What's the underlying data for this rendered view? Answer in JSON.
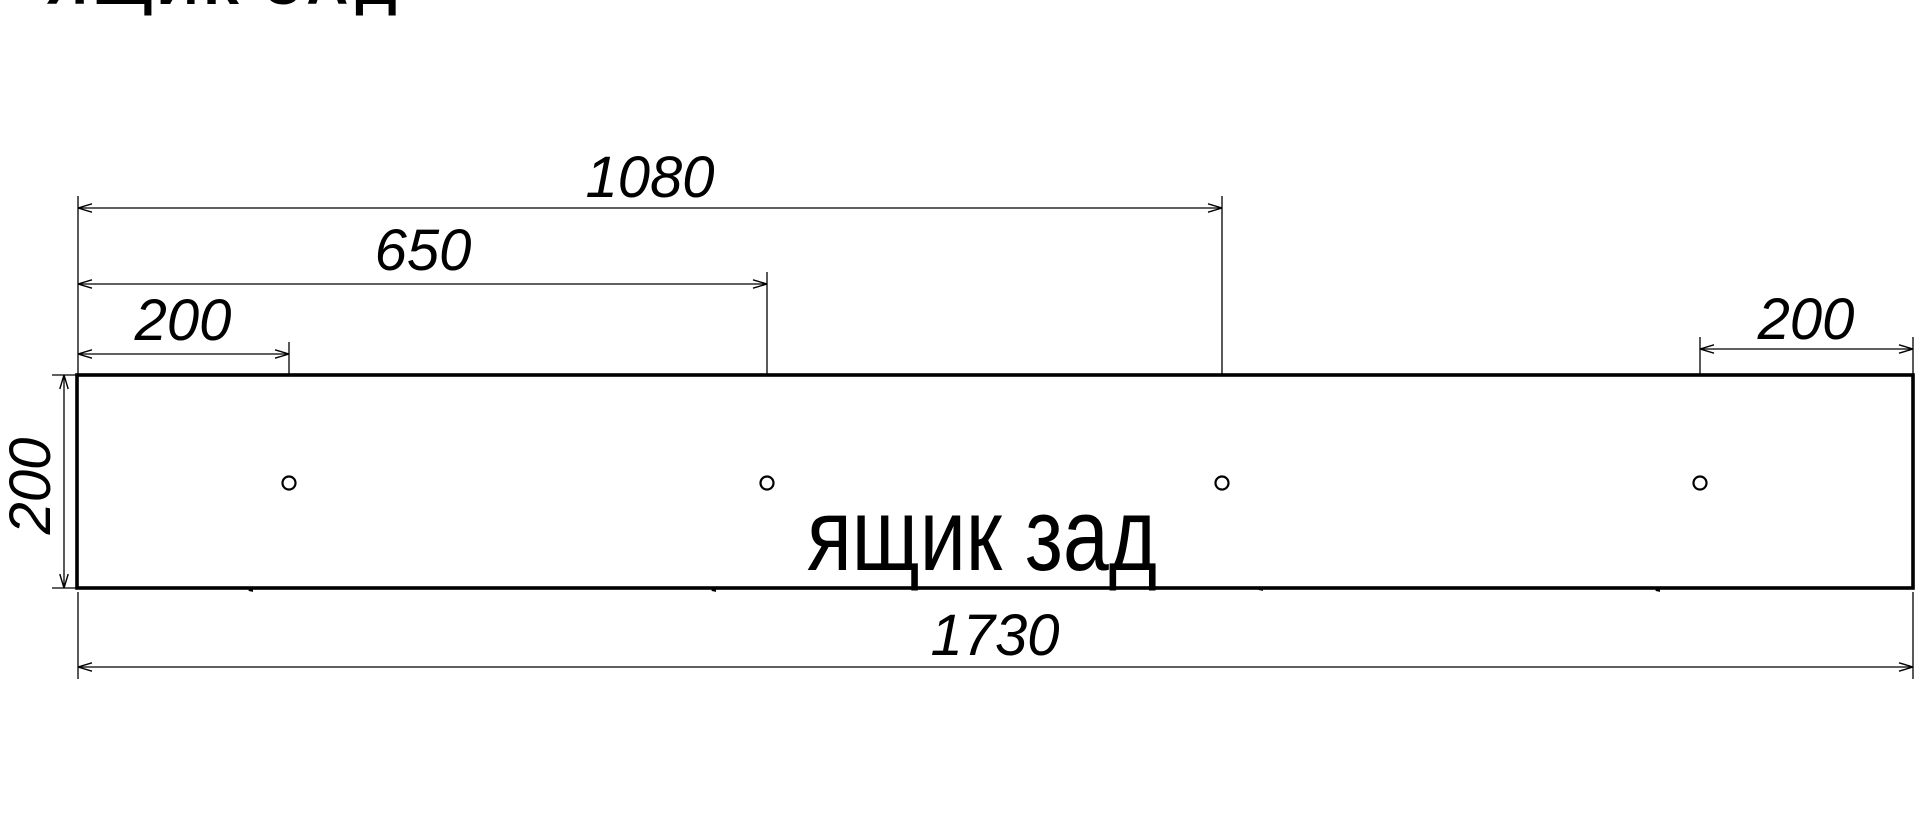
{
  "page_title_clipped": "ЯЩИК ЗАД",
  "part_name": "ящик зад",
  "dimensions": {
    "total_width_mm": "1730",
    "total_height_mm": "200",
    "hole1_from_left_mm": "200",
    "hole2_from_left_mm": "650",
    "hole3_from_left_mm": "1080",
    "hole4_from_right_mm": "200",
    "hole_offset_mm": "100"
  },
  "colors": {
    "line": "#000000",
    "background": "#ffffff",
    "text": "#000000"
  }
}
